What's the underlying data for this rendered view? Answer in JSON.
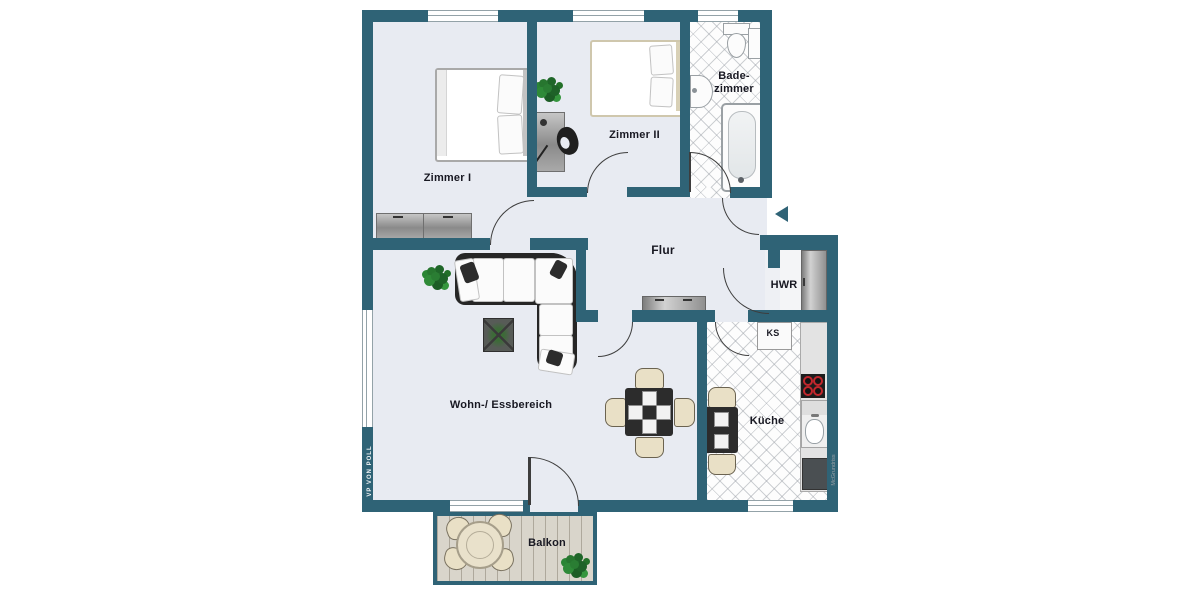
{
  "floorplan": {
    "rooms": {
      "zimmer1": "Zimmer I",
      "zimmer2": "Zimmer II",
      "bad_line1": "Bade-",
      "bad_line2": "zimmer",
      "flur": "Flur",
      "hwr": "HWR",
      "kueche": "Küche",
      "wohn_essbereich": "Wohn-/ Essbereich",
      "balkon": "Balkon"
    },
    "appliance_labels": {
      "ks": "KS"
    },
    "branding": {
      "agency_logo": "VP VON POLL",
      "plan_credit": "McGrundriss"
    },
    "colors": {
      "wall": "#2f6376",
      "floor": "#e8ebf2",
      "tile_bg": "#fdfdfd",
      "balcony_wood": "#d9d5cb",
      "label_text": "#181822",
      "burner_red": "#c1272d"
    }
  }
}
